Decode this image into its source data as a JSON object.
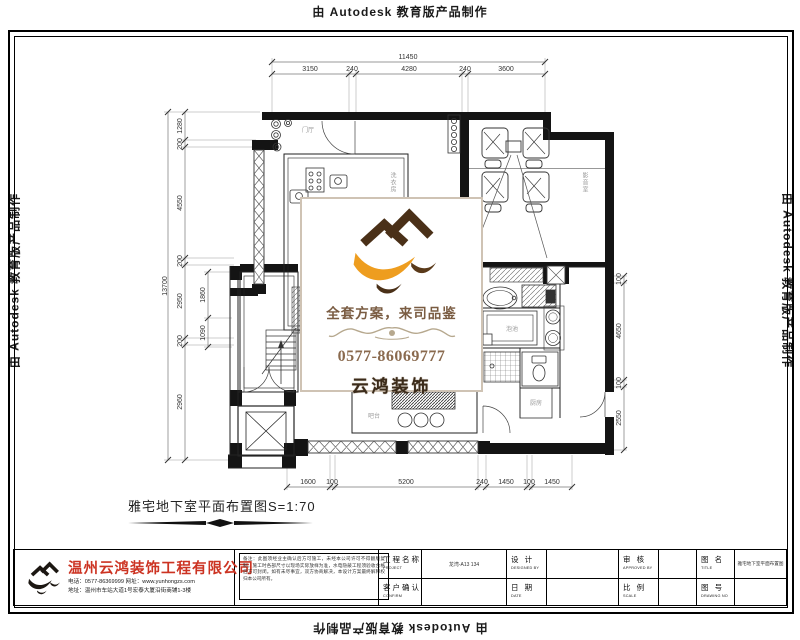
{
  "autodesk": {
    "text": "由 Autodesk 教育版产品制作"
  },
  "watermark": {
    "slogan": "全套方案，来司品鉴",
    "phone": "0577-86069777",
    "brand": "云鸿装饰"
  },
  "drawing": {
    "caption": "雅宅地下室平面布置图S=1:70",
    "dims": {
      "top_total": "11450",
      "top": [
        "3150",
        "240",
        "4280",
        "240",
        "3600"
      ],
      "left_total": "13700",
      "left": [
        "1280",
        "200",
        "4550",
        "200",
        "2950",
        "200",
        "2960"
      ],
      "left_inner": [
        "1860",
        "1090"
      ],
      "bottom": [
        "1600",
        "100",
        "5200",
        "240",
        "1450",
        "100",
        "1450"
      ],
      "right": [
        "100",
        "4650",
        "100",
        "2550"
      ]
    },
    "rooms": {
      "entry": "门厅",
      "laundry": "洗衣房",
      "theater": "影音室",
      "pool": "泡池",
      "bar": "吧台",
      "kitchen": "厨房"
    }
  },
  "titleblock": {
    "company": "温州云鸿装饰工程有限公司",
    "phone_line": "电话：0577-86369999  网址：www.yunhongzs.com",
    "address_line": "地址：温州市车站大道1号宏泰大厦沿街商铺1-3楼",
    "notes": "备注：此图须经业主确认后方可施工，未经本公司许可不得翻版复制。施工时各部尺寸以现场实际放样为准，水电隐蔽工程须验收合格后方可封闭。如有未尽事宜，双方协商解决，本设计方案最终解释权归本公司所有。",
    "cells": {
      "project_label": "工程名称",
      "project_sub": "PROJECT",
      "project_value": "龙湾-A13 134",
      "confirm_label": "客户确认",
      "confirm_sub": "CONFIRM",
      "design_label": "设 计",
      "design_sub": "DESIGNED BY",
      "date_label": "日 期",
      "date_sub": "DATE",
      "approve_label": "审 核",
      "approve_sub": "APPROVED BY",
      "scale_label": "比 例",
      "scale_sub": "SCALE",
      "title_label": "图 名",
      "title_sub": "TITLE",
      "title_value": "雅宅地下室平面布置图",
      "no_label": "图 号",
      "no_sub": "DRAWING NO"
    }
  }
}
